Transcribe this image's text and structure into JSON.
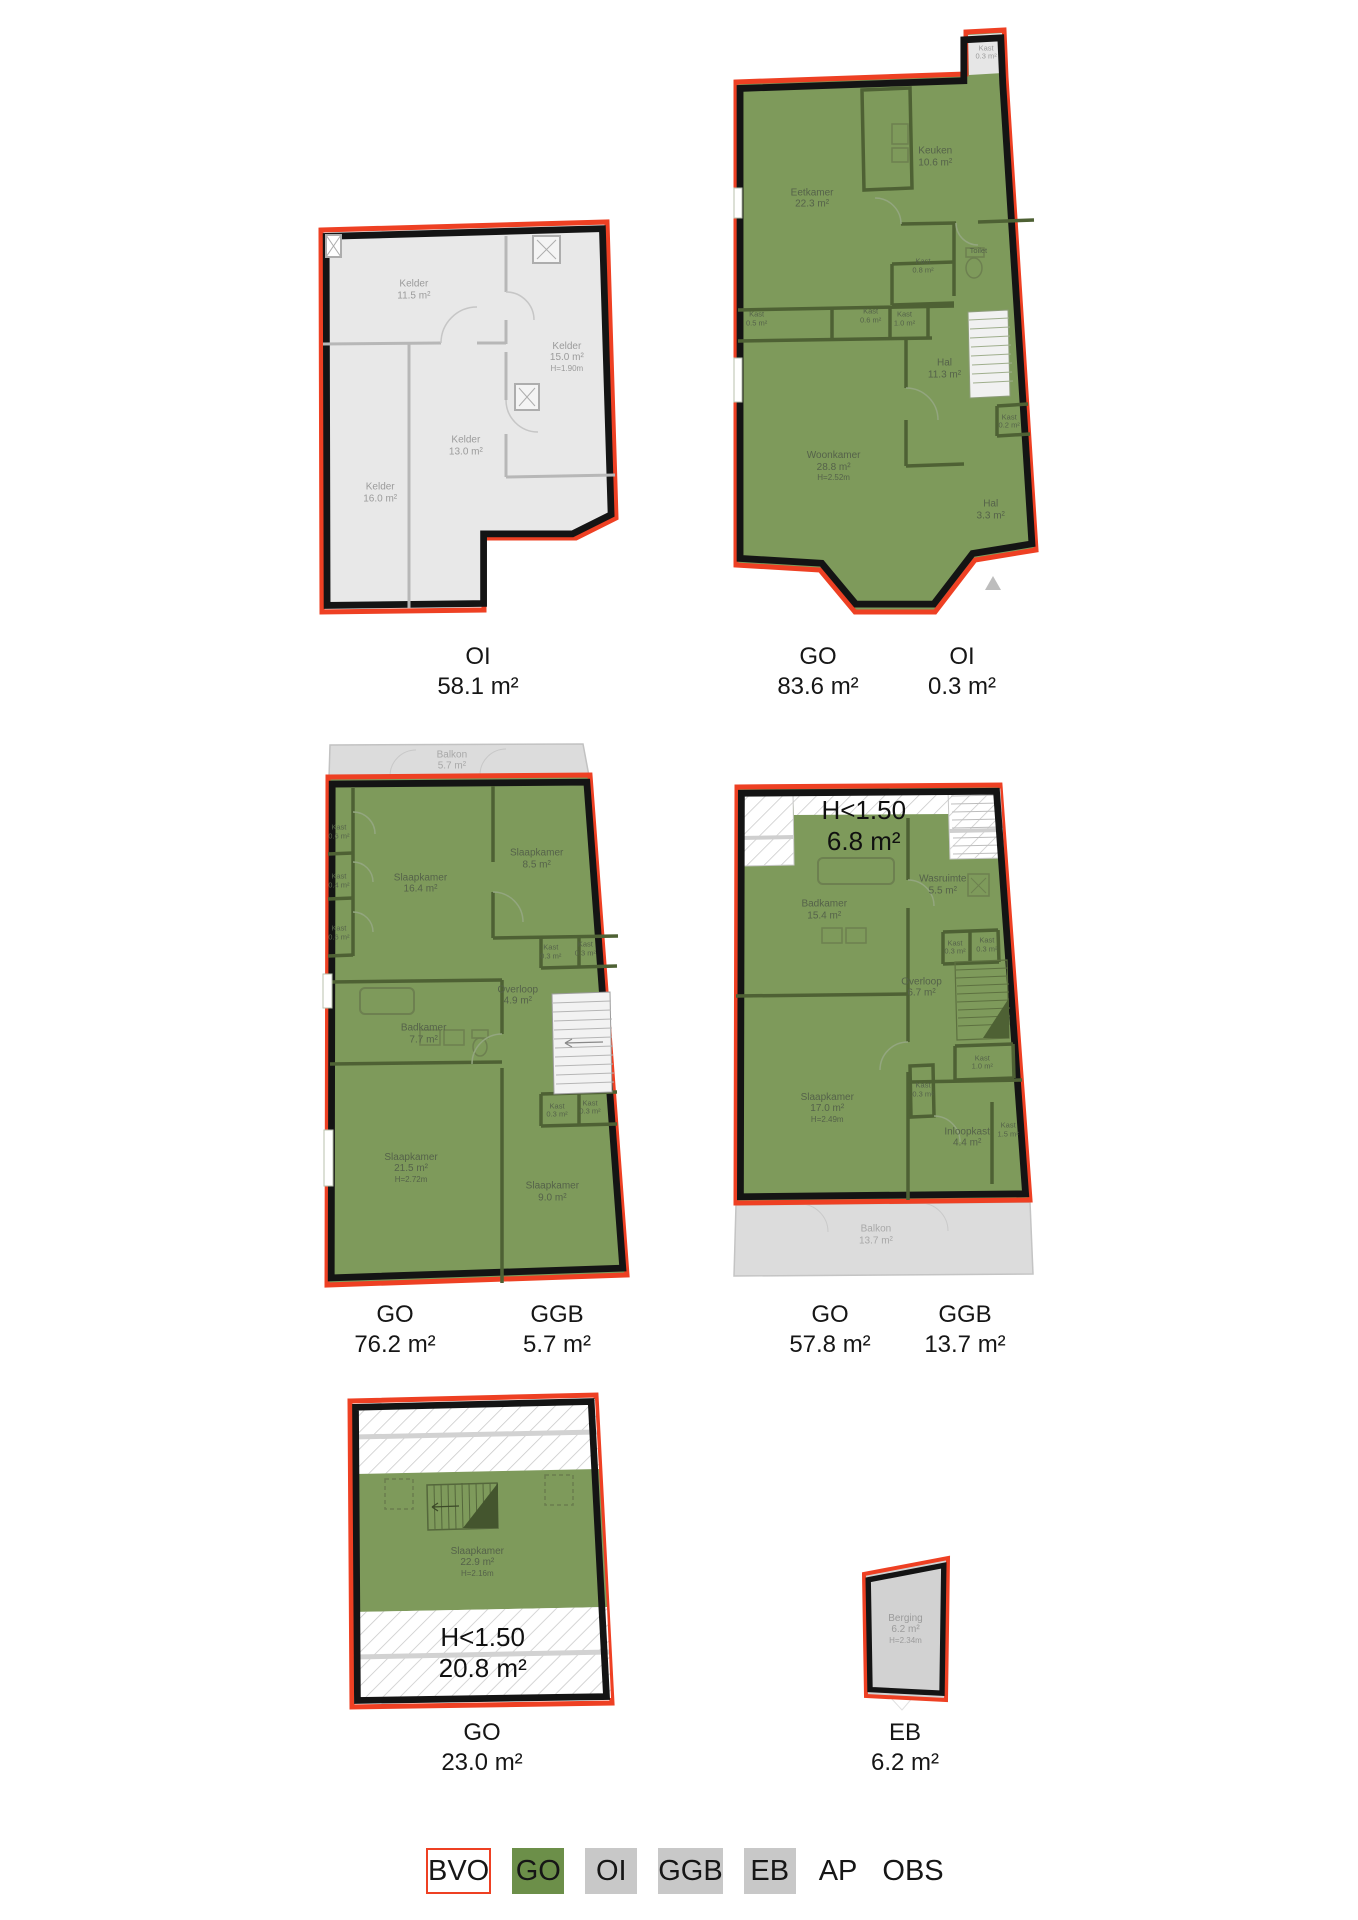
{
  "colors": {
    "bvo_red": "#ee4023",
    "go_green": "#7e9a5b",
    "go_green_dark": "#4e6134",
    "oi_gray": "#e8e8e8",
    "ggb_gray": "#dcdcdc",
    "eb_gray": "#d2d2d2",
    "wall_black": "#141414",
    "legend_go": "#6c8f49",
    "legend_gray": "#c8c8c8"
  },
  "plans": [
    {
      "id": "souterrain",
      "captions": [
        {
          "code": "OI",
          "area": "58.1 m²"
        }
      ],
      "rooms": [
        {
          "name": "Kelder",
          "area": "11.5 m²"
        },
        {
          "name": "Kelder",
          "area": "15.0 m²",
          "height": "H=1.90m"
        },
        {
          "name": "Kelder",
          "area": "13.0 m²"
        },
        {
          "name": "Kelder",
          "area": "16.0 m²"
        }
      ]
    },
    {
      "id": "bel-etage",
      "captions": [
        {
          "code": "GO",
          "area": "83.6 m²"
        },
        {
          "code": "OI",
          "area": "0.3 m²"
        }
      ],
      "rooms": [
        {
          "name": "Eetkamer",
          "area": "22.3 m²"
        },
        {
          "name": "Keuken",
          "area": "10.6 m²"
        },
        {
          "name": "Kast",
          "area": "0.3 m²"
        },
        {
          "name": "Toilet",
          "area": ""
        },
        {
          "name": "Kast",
          "area": "0.8 m²"
        },
        {
          "name": "Kast",
          "area": "0.5 m²"
        },
        {
          "name": "Kast",
          "area": "0.6 m²"
        },
        {
          "name": "Kast",
          "area": "1.0 m²"
        },
        {
          "name": "Hal",
          "area": "11.3 m²"
        },
        {
          "name": "Kast",
          "area": "0.2 m²"
        },
        {
          "name": "Woonkamer",
          "area": "28.8 m²",
          "height": "H=2.52m"
        },
        {
          "name": "Hal",
          "area": "3.3 m²"
        }
      ]
    },
    {
      "id": "eerste-verdieping",
      "captions": [
        {
          "code": "GO",
          "area": "76.2 m²"
        },
        {
          "code": "GGB",
          "area": "5.7 m²"
        }
      ],
      "rooms": [
        {
          "name": "Balkon",
          "area": "5.7 m²"
        },
        {
          "name": "Kast",
          "area": "0.6 m²"
        },
        {
          "name": "Kast",
          "area": "0.4 m²"
        },
        {
          "name": "Kast",
          "area": "0.6 m²"
        },
        {
          "name": "Slaapkamer",
          "area": "16.4 m²"
        },
        {
          "name": "Slaapkamer",
          "area": "8.5 m²"
        },
        {
          "name": "Kast",
          "area": "0.3 m²"
        },
        {
          "name": "Kast",
          "area": "0.3 m²"
        },
        {
          "name": "Overloop",
          "area": "4.9 m²"
        },
        {
          "name": "Badkamer",
          "area": "7.7 m²"
        },
        {
          "name": "Kast",
          "area": "0.3 m²"
        },
        {
          "name": "Kast",
          "area": "0.3 m²"
        },
        {
          "name": "Slaapkamer",
          "area": "21.5 m²",
          "height": "H=2.72m"
        },
        {
          "name": "Slaapkamer",
          "area": "9.0 m²"
        }
      ]
    },
    {
      "id": "tweede-verdieping",
      "captions": [
        {
          "code": "GO",
          "area": "57.8 m²"
        },
        {
          "code": "GGB",
          "area": "13.7 m²"
        }
      ],
      "low_zone": {
        "line1": "H<1.50",
        "line2": "6.8 m²"
      },
      "rooms": [
        {
          "name": "Badkamer",
          "area": "15.4 m²"
        },
        {
          "name": "Wasruimte",
          "area": "5.5 m²"
        },
        {
          "name": "Kast",
          "area": "0.3 m²"
        },
        {
          "name": "Kast",
          "area": "0.3 m²"
        },
        {
          "name": "Overloop",
          "area": "6.7 m²"
        },
        {
          "name": "Kast",
          "area": "1.0 m²"
        },
        {
          "name": "Kast",
          "area": "0.3 m²"
        },
        {
          "name": "Slaapkamer",
          "area": "17.0 m²",
          "height": "H=2.49m"
        },
        {
          "name": "Inloopkast",
          "area": "4.4 m²"
        },
        {
          "name": "Kast",
          "area": "1.5 m²"
        },
        {
          "name": "Balkon",
          "area": "13.7 m²"
        }
      ]
    },
    {
      "id": "zolder",
      "captions": [
        {
          "code": "GO",
          "area": "23.0 m²"
        }
      ],
      "low_zone": {
        "line1": "H<1.50",
        "line2": "20.8 m²"
      },
      "rooms": [
        {
          "name": "Slaapkamer",
          "area": "22.9 m²",
          "height": "H=2.16m"
        }
      ]
    },
    {
      "id": "berging",
      "captions": [
        {
          "code": "EB",
          "area": "6.2 m²"
        }
      ],
      "rooms": [
        {
          "name": "Berging",
          "area": "6.2 m²",
          "height": "H=2.34m"
        }
      ]
    }
  ],
  "legend": {
    "items": [
      {
        "label": "BVO"
      },
      {
        "label": "GO"
      },
      {
        "label": "OI"
      },
      {
        "label": "GGB"
      },
      {
        "label": "EB"
      },
      {
        "label": "AP"
      },
      {
        "label": "OBS"
      }
    ]
  }
}
